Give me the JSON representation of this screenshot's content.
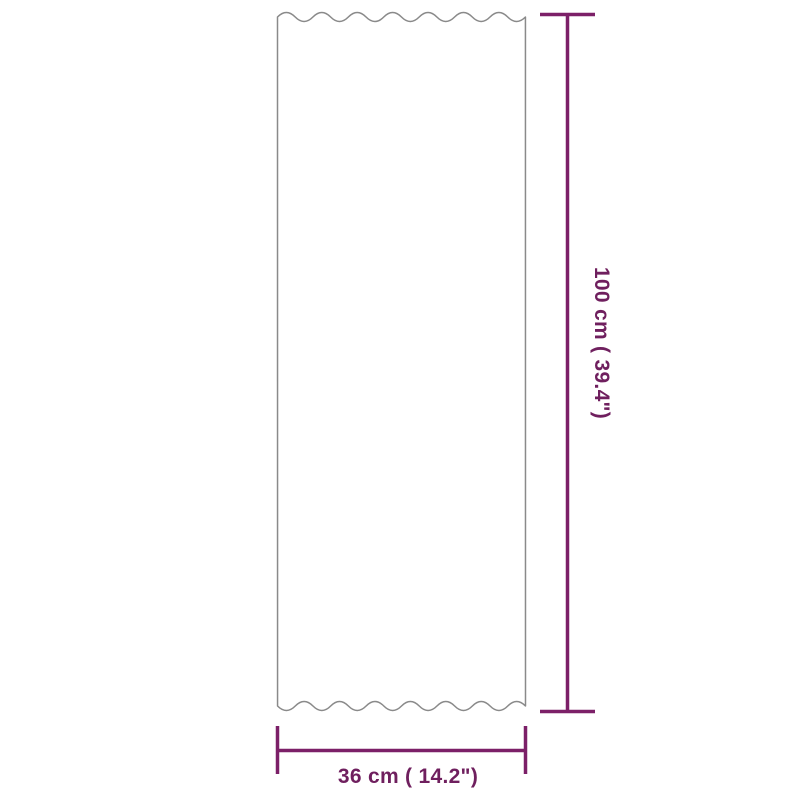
{
  "diagram": {
    "kind": "product-dimension-diagram",
    "shape": "corrugated-sheet-panel",
    "height_label": "100 cm ( 39.4\")",
    "width_label": "36 cm ( 14.2\")",
    "colors": {
      "dimension_line": "#7C2068",
      "dimension_text": "#6F1F5E",
      "panel_outline": "#8A8A8A",
      "background": "#FFFFFF"
    }
  }
}
